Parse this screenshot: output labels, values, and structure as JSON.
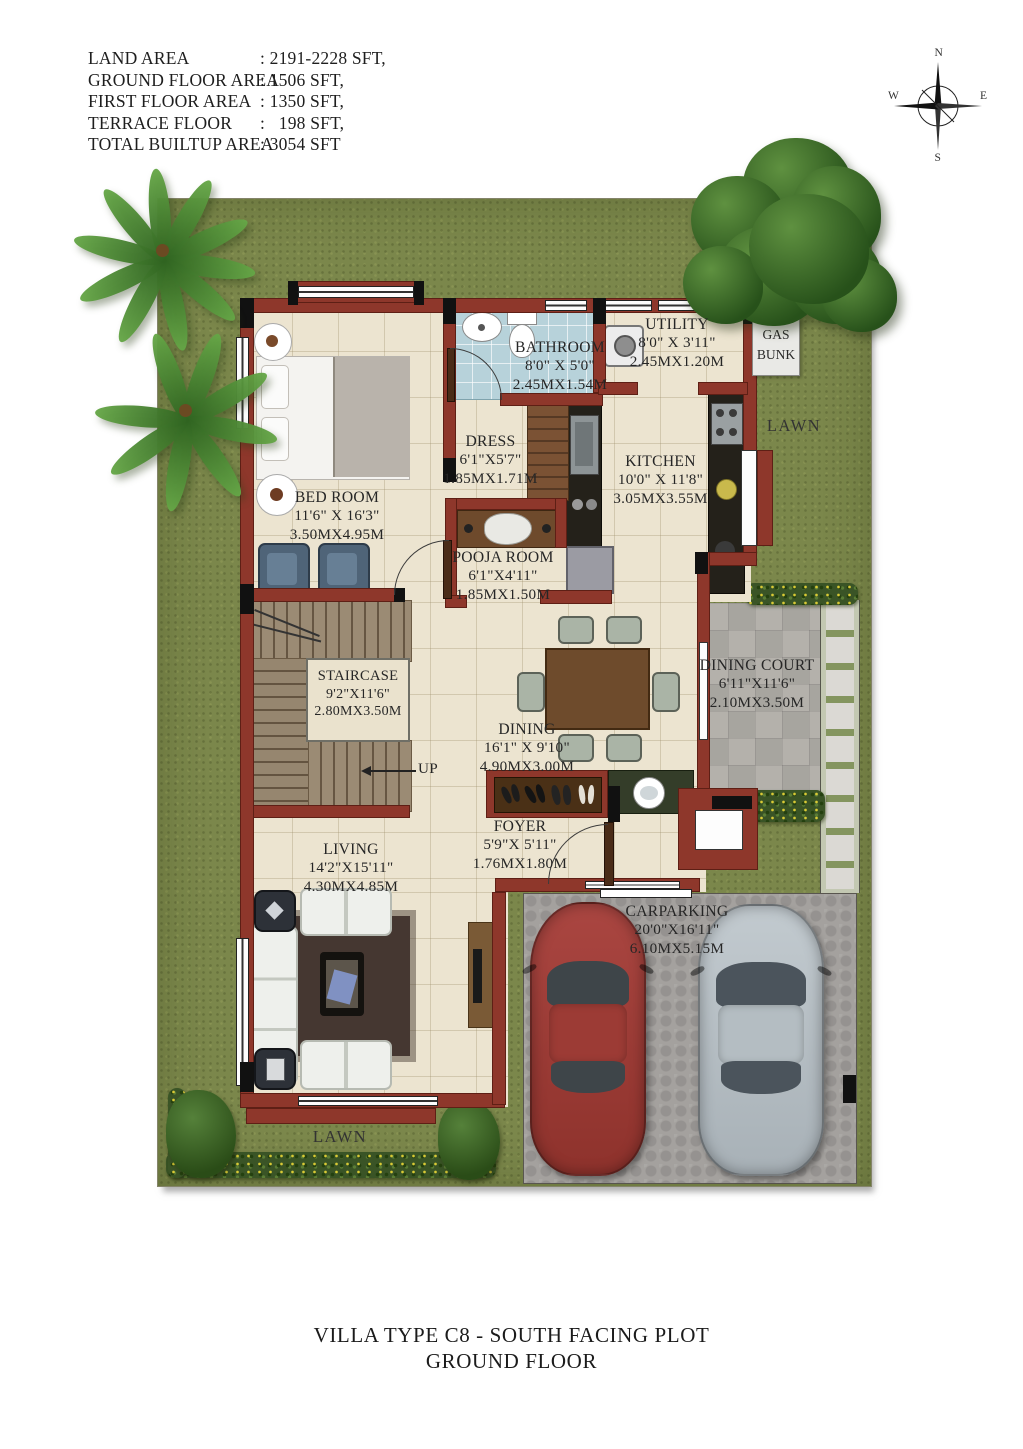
{
  "header": {
    "info_rows": [
      {
        "label": "LAND AREA",
        "value": ": 2191-2228 SFT,"
      },
      {
        "label": "GROUND FLOOR AREA",
        "value": ": 1506 SFT,"
      },
      {
        "label": "FIRST FLOOR AREA",
        "value": ": 1350 SFT,"
      },
      {
        "label": "TERRACE FLOOR",
        "value": ":   198 SFT,"
      },
      {
        "label": "TOTAL BUILTUP AREA",
        "value": ": 3054 SFT"
      }
    ],
    "compass": {
      "north": "N",
      "east": "E",
      "south": "S",
      "west": "W"
    }
  },
  "rooms": {
    "bathroom": {
      "name": "BATHROOM",
      "size_ft": "8'0\" X 5'0\"",
      "size_m": "2.45MX1.54M"
    },
    "utility": {
      "name": "UTILITY",
      "size_ft": "8'0\" X 3'11\"",
      "size_m": "2.45MX1.20M"
    },
    "dress": {
      "name": "DRESS",
      "size_ft": "6'1\"X5'7\"",
      "size_m": "1.85MX1.71M"
    },
    "kitchen": {
      "name": "KITCHEN",
      "size_ft": "10'0\" X 11'8\"",
      "size_m": "3.05MX3.55M"
    },
    "bed_room": {
      "name": "BED ROOM",
      "size_ft": "11'6\" X 16'3\"",
      "size_m": "3.50MX4.95M"
    },
    "pooja_room": {
      "name": "POOJA ROOM",
      "size_ft": "6'1\"X4'11\"",
      "size_m": "1.85MX1.50M"
    },
    "staircase": {
      "name": "STAIRCASE",
      "size_ft": "9'2\"X11'6\"",
      "size_m": "2.80MX3.50M"
    },
    "dining": {
      "name": "DINING",
      "size_ft": "16'1\" X 9'10\"",
      "size_m": "4.90MX3.00M"
    },
    "dining_court": {
      "name": "DINING COURT",
      "size_ft": "6'11\"X11'6\"",
      "size_m": "2.10MX3.50M"
    },
    "foyer": {
      "name": "FOYER",
      "size_ft": "5'9\"X 5'11\"",
      "size_m": "1.76MX1.80M"
    },
    "living": {
      "name": "LIVING",
      "size_ft": "14'2\"X15'11\"",
      "size_m": "4.30MX4.85M"
    },
    "carparking": {
      "name": "CARPARKING",
      "size_ft": "20'0\"X16'11\"",
      "size_m": "6.10MX5.15M"
    },
    "gas_bunk": {
      "line1": "GAS",
      "line2": "BUNK"
    },
    "lawn_right": "LAWN",
    "lawn_bottom": "LAWN",
    "up_label": "UP"
  },
  "footer": {
    "title_line1": "VILLA TYPE C8 - SOUTH FACING PLOT",
    "title_line2": "GROUND FLOOR"
  },
  "colors": {
    "wall": "#8e372b",
    "lawn": "#7b874b",
    "floor": "#ece4d0",
    "bath_tile": "#b7d2da",
    "paver": "#a4a19e",
    "court_paver": "#b4b1ab",
    "hedge": "#3a5426",
    "car_red": "#9f3f38",
    "car_silver": "#b7bfc4"
  }
}
